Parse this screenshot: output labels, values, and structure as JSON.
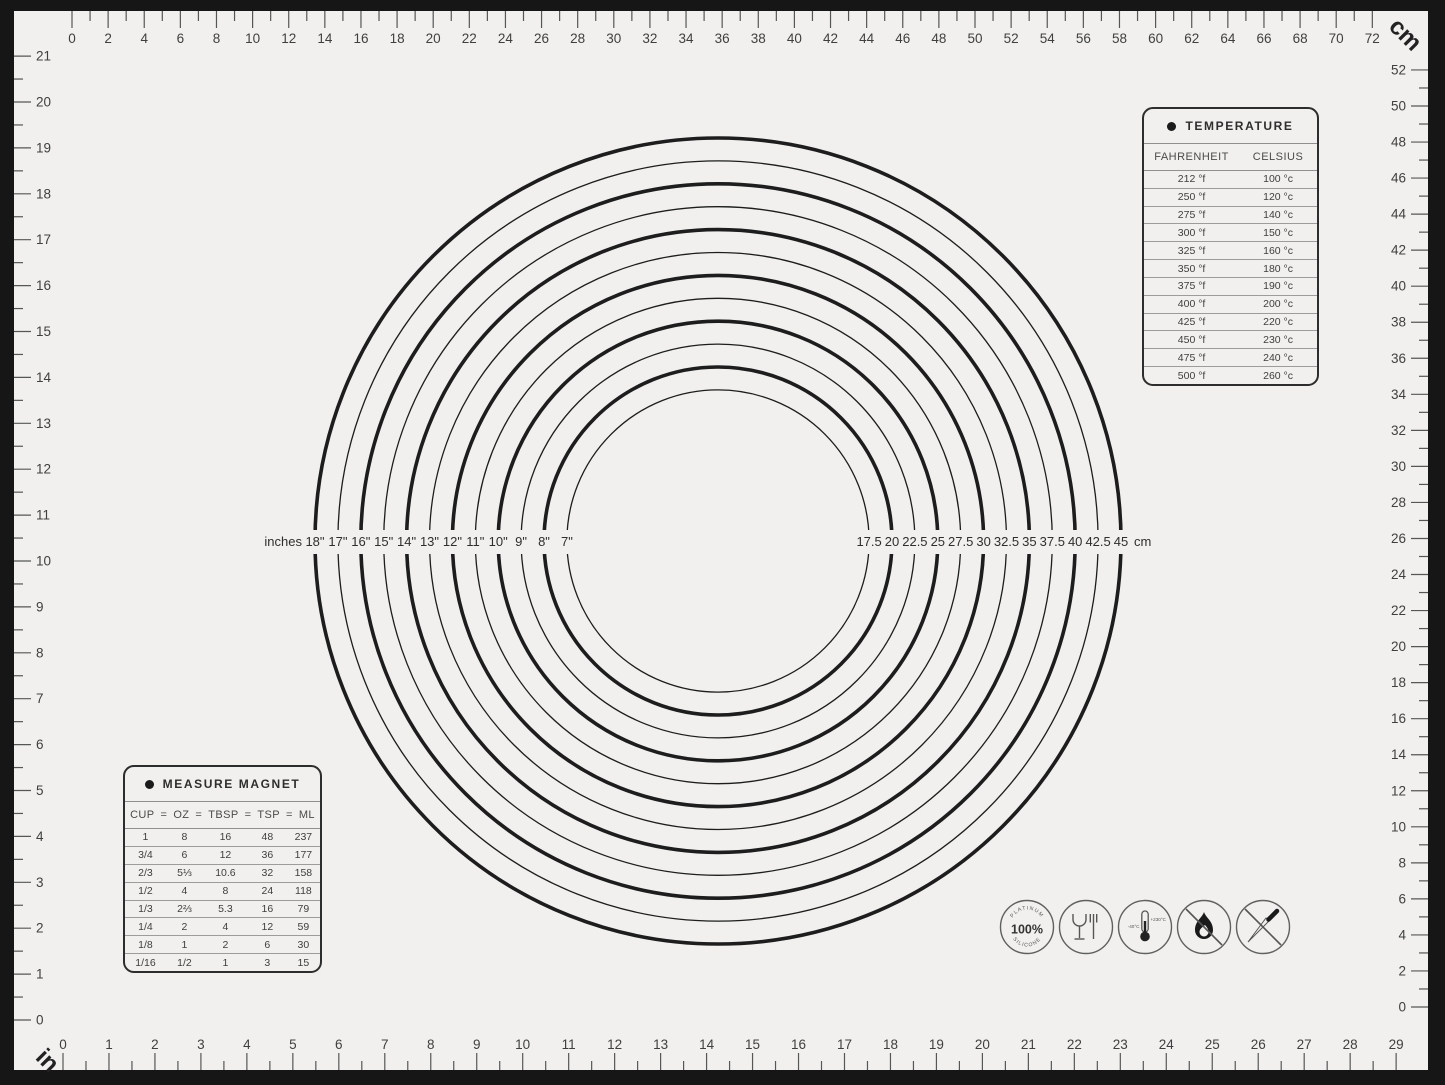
{
  "colors": {
    "frame": "#161616",
    "mat": "#f1f0ee",
    "ink": "#1d1d1d",
    "tick": "#565656",
    "number": "#3f3f3f",
    "icon_stroke": "#606060"
  },
  "rulers": {
    "top_cm": {
      "unit": "cm",
      "labels": [
        0,
        2,
        4,
        6,
        8,
        10,
        12,
        14,
        16,
        18,
        20,
        22,
        24,
        26,
        28,
        30,
        32,
        34,
        36,
        38,
        40,
        42,
        44,
        46,
        48,
        50,
        52,
        54,
        56,
        58,
        60,
        62,
        64,
        66,
        68,
        70,
        72
      ]
    },
    "right_cm": {
      "labels": [
        52,
        50,
        48,
        46,
        44,
        42,
        40,
        38,
        36,
        34,
        32,
        30,
        28,
        26,
        24,
        22,
        20,
        18,
        16,
        14,
        12,
        10,
        8,
        6,
        4,
        2,
        0
      ]
    },
    "bottom_in": {
      "unit": "in",
      "labels": [
        0,
        1,
        2,
        3,
        4,
        5,
        6,
        7,
        8,
        9,
        10,
        11,
        12,
        13,
        14,
        15,
        16,
        17,
        18,
        19,
        20,
        21,
        22,
        23,
        24,
        25,
        26,
        27,
        28,
        29
      ]
    },
    "left_in": {
      "labels": [
        21,
        20,
        19,
        18,
        17,
        16,
        15,
        14,
        13,
        12,
        11,
        10,
        9,
        8,
        7,
        6,
        5,
        4,
        3,
        2,
        1,
        0
      ]
    }
  },
  "circles": {
    "left_unit": "inches",
    "right_unit": "cm",
    "rings": [
      {
        "inches": "18\"",
        "cm": "45"
      },
      {
        "inches": "17\"",
        "cm": "42.5"
      },
      {
        "inches": "16\"",
        "cm": "40"
      },
      {
        "inches": "15\"",
        "cm": "37.5"
      },
      {
        "inches": "14\"",
        "cm": "35"
      },
      {
        "inches": "13\"",
        "cm": "32.5"
      },
      {
        "inches": "12\"",
        "cm": "30"
      },
      {
        "inches": "11\"",
        "cm": "27.5"
      },
      {
        "inches": "10\"",
        "cm": "25"
      },
      {
        "inches": "9\"",
        "cm": "22.5"
      },
      {
        "inches": "8\"",
        "cm": "20"
      },
      {
        "inches": "7\"",
        "cm": "17.5"
      }
    ]
  },
  "temperature_table": {
    "title": "TEMPERATURE",
    "columns": [
      "FAHRENHEIT",
      "CELSIUS"
    ],
    "rows": [
      [
        "212 °f",
        "100 °c"
      ],
      [
        "250 °f",
        "120 °c"
      ],
      [
        "275 °f",
        "140 °c"
      ],
      [
        "300 °f",
        "150 °c"
      ],
      [
        "325 °f",
        "160 °c"
      ],
      [
        "350 °f",
        "180 °c"
      ],
      [
        "375 °f",
        "190 °c"
      ],
      [
        "400 °f",
        "200 °c"
      ],
      [
        "425 °f",
        "220 °c"
      ],
      [
        "450 °f",
        "230 °c"
      ],
      [
        "475 °f",
        "240 °c"
      ],
      [
        "500 °f",
        "260 °c"
      ]
    ]
  },
  "measure_table": {
    "title": "MEASURE MAGNET",
    "columns": [
      "CUP",
      "OZ",
      "TBSP",
      "TSP",
      "ML"
    ],
    "joiner": "=",
    "rows": [
      [
        "1",
        "8",
        "16",
        "48",
        "237"
      ],
      [
        "3/4",
        "6",
        "12",
        "36",
        "177"
      ],
      [
        "2/3",
        "5⅓",
        "10.6",
        "32",
        "158"
      ],
      [
        "1/2",
        "4",
        "8",
        "24",
        "118"
      ],
      [
        "1/3",
        "2⅔",
        "5.3",
        "16",
        "79"
      ],
      [
        "1/4",
        "2",
        "4",
        "12",
        "59"
      ],
      [
        "1/8",
        "1",
        "2",
        "6",
        "30"
      ],
      [
        "1/16",
        "1/2",
        "1",
        "3",
        "15"
      ]
    ]
  },
  "icons": [
    {
      "name": "platinum-silicone-icon",
      "arc_top": "PLATINUM",
      "center": "100%",
      "arc_bottom": "SILICONE"
    },
    {
      "name": "food-contact-safe-icon"
    },
    {
      "name": "temperature-range-icon",
      "min": "-40°C",
      "max": "+230°C"
    },
    {
      "name": "no-open-flame-icon"
    },
    {
      "name": "no-knife-icon"
    }
  ]
}
